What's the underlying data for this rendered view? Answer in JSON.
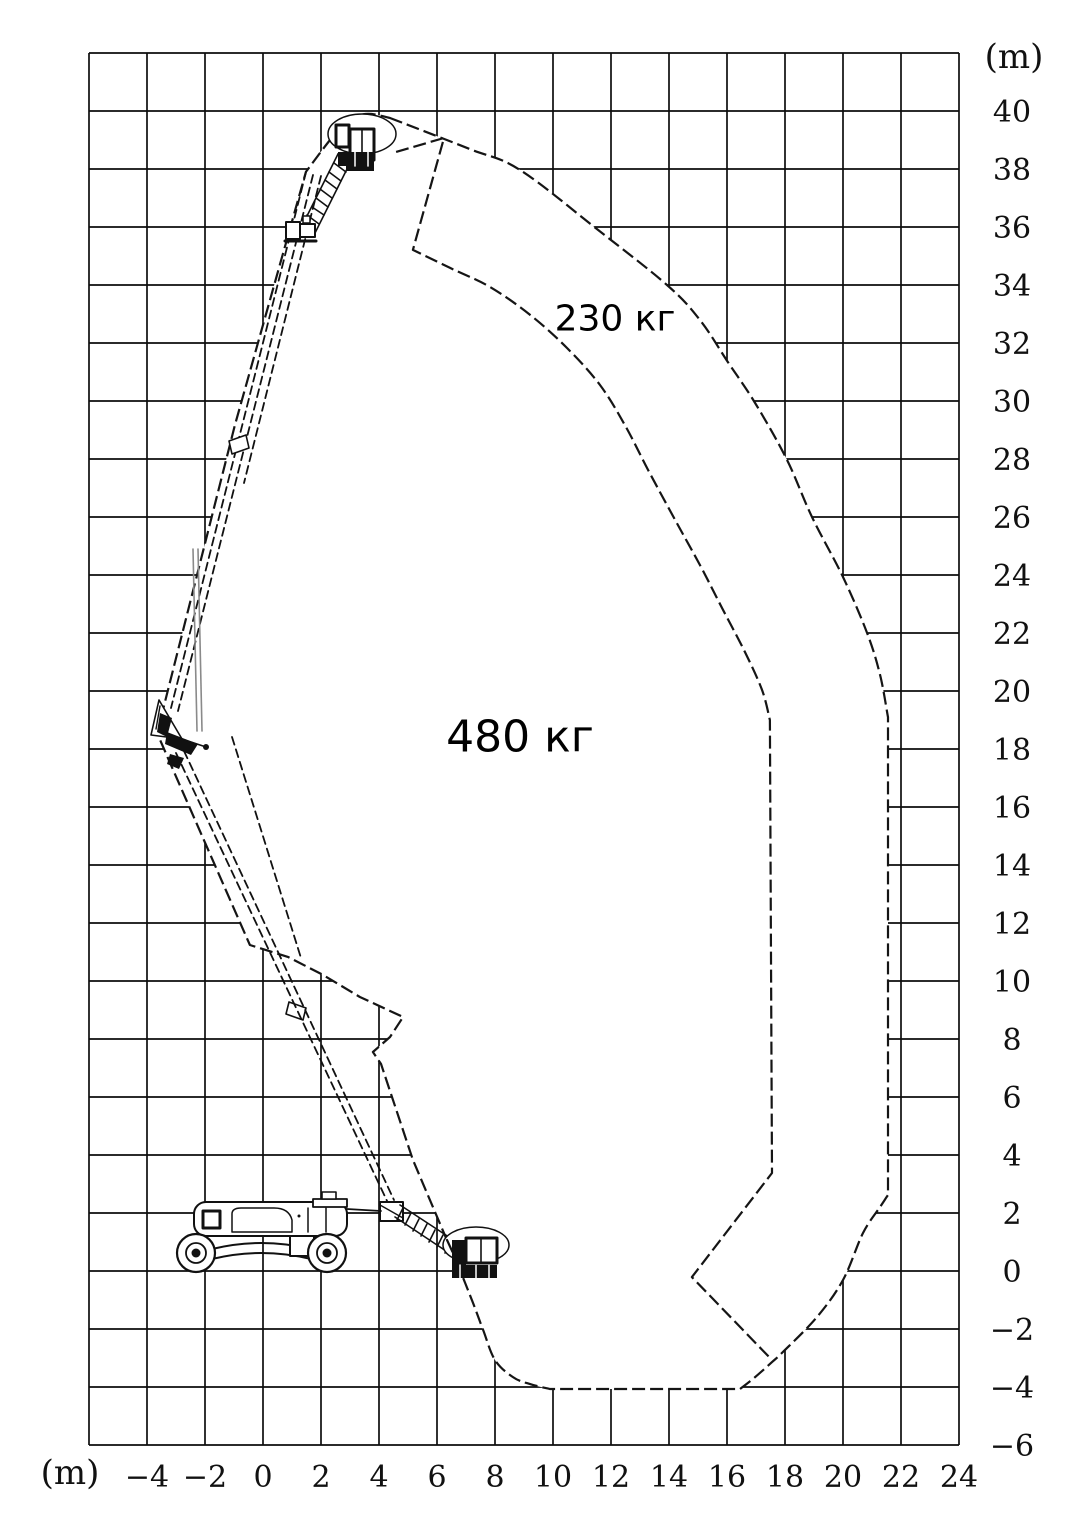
{
  "page": {
    "background": "#ffffff",
    "line_color": "#111111"
  },
  "figure": {
    "type": "load-envelope-diagram",
    "subject": "articulated-boom-lift-working-envelope",
    "unit_top": "(m)",
    "unit_bottom": "(m)",
    "axes": {
      "x": {
        "min": -6,
        "max": 24,
        "step": 2,
        "tick_values": [
          -4,
          -2,
          0,
          2,
          4,
          6,
          8,
          10,
          12,
          14,
          16,
          18,
          20,
          22,
          24
        ],
        "tick_labels": [
          "−4",
          "−2",
          "0",
          "2",
          "4",
          "6",
          "8",
          "10",
          "12",
          "14",
          "16",
          "18",
          "20",
          "22",
          "24"
        ]
      },
      "y": {
        "min": -6,
        "max": 42,
        "step": 2,
        "tick_values": [
          40,
          38,
          36,
          34,
          32,
          30,
          28,
          26,
          24,
          22,
          20,
          18,
          16,
          14,
          12,
          10,
          8,
          6,
          4,
          2,
          0,
          -2,
          -4,
          -6
        ],
        "tick_labels": [
          "40",
          "38",
          "36",
          "34",
          "32",
          "30",
          "28",
          "26",
          "24",
          "22",
          "20",
          "18",
          "16",
          "14",
          "12",
          "10",
          "8",
          "6",
          "4",
          "2",
          "0",
          "−2",
          "−4",
          "−6"
        ]
      }
    },
    "mapping": {
      "x0": 263,
      "y0": 1271,
      "scale": 29
    },
    "chart_data": {
      "type": "area",
      "title": "",
      "xlabel": "(m)",
      "ylabel": "(m)",
      "xlim": [
        -6,
        24
      ],
      "ylim": [
        -6,
        42
      ],
      "grid": true,
      "regions": [
        {
          "name": "outer-envelope-230kg",
          "load_label": "230 кг",
          "closed": true,
          "segments": [
            {
              "type": "curve",
              "points": [
                [
                  4.38,
                  39.76
                ],
                [
                  7.1,
                  38.7
                ],
                [
                  8.86,
                  37.97
                ],
                [
                  11.55,
                  35.9
                ],
                [
                  13.93,
                  34.0
                ],
                [
                  15.07,
                  32.79
                ],
                [
                  16.03,
                  31.34
                ],
                [
                  16.97,
                  29.93
                ],
                [
                  18.07,
                  27.97
                ],
                [
                  18.93,
                  26.0
                ],
                [
                  20.0,
                  23.93
                ],
                [
                  20.83,
                  22.0
                ],
                [
                  21.28,
                  20.55
                ],
                [
                  21.55,
                  19.1
                ]
              ]
            },
            {
              "type": "line",
              "points": [
                [
                  21.55,
                  19.1
                ],
                [
                  21.55,
                  2.62
                ]
              ]
            },
            {
              "type": "curve",
              "points": [
                [
                  21.55,
                  2.62
                ],
                [
                  21.28,
                  2.21
                ],
                [
                  20.69,
                  1.31
                ],
                [
                  20.0,
                  -0.31
                ],
                [
                  19.1,
                  -1.59
                ],
                [
                  17.93,
                  -2.79
                ],
                [
                  17.55,
                  -3.14
                ],
                [
                  16.97,
                  -3.66
                ],
                [
                  16.45,
                  -4.07
                ]
              ]
            },
            {
              "type": "line",
              "points": [
                [
                  16.45,
                  -4.07
                ],
                [
                  9.9,
                  -4.07
                ]
              ]
            },
            {
              "type": "curve",
              "points": [
                [
                  9.9,
                  -4.07
                ],
                [
                  9.21,
                  -3.9
                ],
                [
                  8.62,
                  -3.66
                ],
                [
                  8.0,
                  -3.07
                ],
                [
                  7.59,
                  -2.03
                ],
                [
                  7.24,
                  -1.1
                ],
                [
                  6.69,
                  0.28
                ],
                [
                  6.34,
                  1.07
                ]
              ]
            },
            {
              "type": "line",
              "points": [
                [
                  6.34,
                  1.07
                ],
                [
                  5.17,
                  3.83
                ],
                [
                  4.07,
                  7.14
                ],
                [
                  3.79,
                  7.55
                ],
                [
                  4.38,
                  8.07
                ],
                [
                  4.83,
                  8.76
                ],
                [
                  3.34,
                  9.45
                ],
                [
                  2.07,
                  10.21
                ],
                [
                  0.86,
                  10.83
                ],
                [
                  -0.45,
                  11.24
                ],
                [
                  -3.28,
                  17.69
                ],
                [
                  -3.62,
                  18.48
                ],
                [
                  -3.45,
                  19.34
                ],
                [
                  -0.97,
                  29.17
                ],
                [
                  1.48,
                  37.9
                ]
              ]
            },
            {
              "type": "curve",
              "points": [
                [
                  1.48,
                  37.9
                ],
                [
                  2.31,
                  39.0
                ],
                [
                  2.93,
                  39.69
                ],
                [
                  3.62,
                  39.9
                ],
                [
                  4.38,
                  39.76
                ]
              ]
            }
          ]
        },
        {
          "name": "inner-boundary-480kg",
          "load_label": "480 кг",
          "closed": false,
          "segments": [
            {
              "type": "line",
              "points": [
                [
                  4.59,
                  38.59
                ],
                [
                  6.24,
                  39.07
                ],
                [
                  5.17,
                  35.21
                ]
              ]
            },
            {
              "type": "curve",
              "points": [
                [
                  5.17,
                  35.21
                ],
                [
                  6.45,
                  34.59
                ],
                [
                  7.83,
                  33.93
                ],
                [
                  9.21,
                  32.97
                ],
                [
                  10.48,
                  31.83
                ],
                [
                  11.62,
                  30.55
                ],
                [
                  12.48,
                  29.17
                ],
                [
                  13.28,
                  27.62
                ],
                [
                  14.21,
                  25.9
                ],
                [
                  15.07,
                  24.34
                ],
                [
                  15.83,
                  22.86
                ],
                [
                  16.62,
                  21.34
                ],
                [
                  17.21,
                  20.03
                ],
                [
                  17.48,
                  19.0
                ]
              ]
            },
            {
              "type": "line",
              "points": [
                [
                  17.48,
                  19.0
                ],
                [
                  17.55,
                  3.38
                ],
                [
                  14.79,
                  -0.21
                ],
                [
                  17.55,
                  -3.07
                ]
              ]
            }
          ]
        }
      ],
      "labels": [
        {
          "text": "230 кг",
          "x_m": 12.1,
          "y_m": 32.9
        },
        {
          "text": "480 кг",
          "x_m": 8.9,
          "y_m": 18.4
        }
      ]
    }
  }
}
